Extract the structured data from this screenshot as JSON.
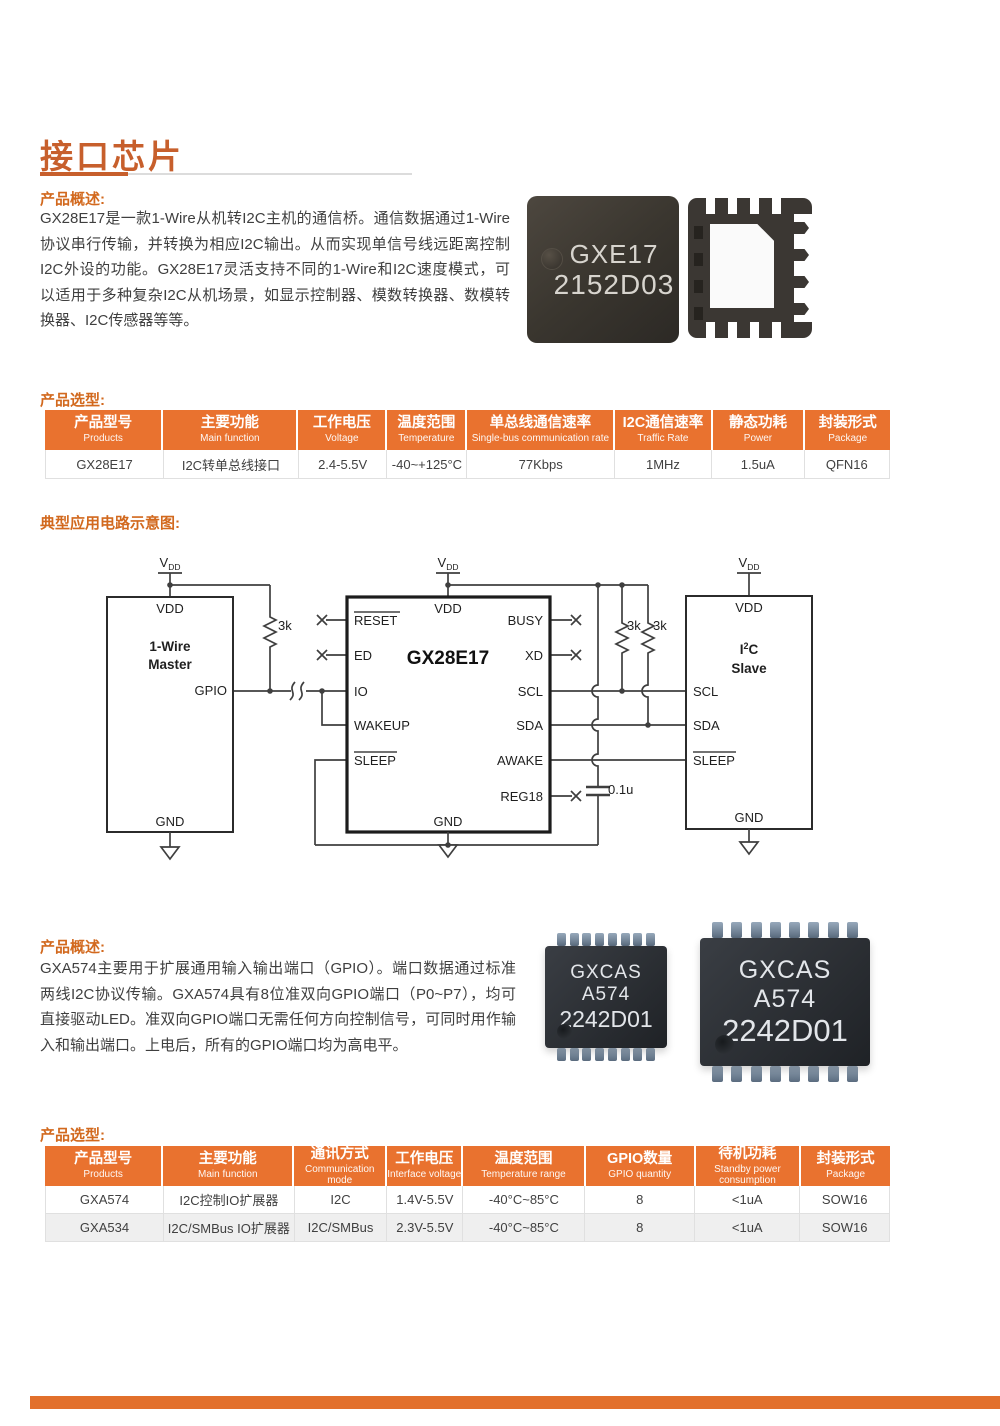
{
  "title": {
    "text": "接口芯片"
  },
  "labels": {
    "overview": "产品概述:",
    "selection": "产品选型:",
    "circuit": "典型应用电路示意图:"
  },
  "overview1": "GX28E17是一款1-Wire从机转I2C主机的通信桥。通信数据通过1-Wire协议串行传输，并转换为相应I2C输出。从而实现单信号线远距离控制I2C外设的功能。GX28E17灵活支持不同的1-Wire和I2C速度模式，可以适用于多种复杂I2C从机场景，如显示控制器、模数转换器、数模转换器、I2C传感器等等。",
  "overview2": "GXA574主要用于扩展通用输入输出端口（GPIO）。端口数据通过标准两线I2C协议传输。GXA574具有8位准双向GPIO端口（P0~P7），均可直接驱动LED。准双向GPIO端口无需任何方向控制信号，可同时用作输入和输出端口。上电后，所有的GPIO端口均为高电平。",
  "chips": {
    "qfn_top": {
      "line1": "GXE17",
      "line2": "2152D03"
    },
    "soic": {
      "line1": "GXCAS",
      "line2": "A574",
      "line3": "2242D01"
    }
  },
  "tables": {
    "t1": {
      "headers": [
        {
          "zh": "产品型号",
          "en": "Products"
        },
        {
          "zh": "主要功能",
          "en": "Main function"
        },
        {
          "zh": "工作电压",
          "en": "Voltage"
        },
        {
          "zh": "温度范围",
          "en": "Temperature"
        },
        {
          "zh": "单总线通信速率",
          "en": "Single-bus communication rate"
        },
        {
          "zh": "I2C通信速率",
          "en": "Traffic Rate"
        },
        {
          "zh": "静态功耗",
          "en": "Power"
        },
        {
          "zh": "封装形式",
          "en": "Package"
        }
      ],
      "rows": [
        [
          "GX28E17",
          "I2C转单总线接口",
          "2.4-5.5V",
          "-40~+125°C",
          "77Kbps",
          "1MHz",
          "1.5uA",
          "QFN16"
        ]
      ]
    },
    "t2": {
      "headers": [
        {
          "zh": "产品型号",
          "en": "Products"
        },
        {
          "zh": "主要功能",
          "en": "Main function"
        },
        {
          "zh": "通讯方式",
          "en": "Communication mode"
        },
        {
          "zh": "工作电压",
          "en": "Interface voltage"
        },
        {
          "zh": "温度范围",
          "en": "Temperature range"
        },
        {
          "zh": "GPIO数量",
          "en": "GPIO quantity"
        },
        {
          "zh": "待机功耗",
          "en": "Standby power consumption"
        },
        {
          "zh": "封装形式",
          "en": "Package"
        }
      ],
      "rows": [
        [
          "GXA574",
          "I2C控制IO扩展器",
          "I2C",
          "1.4V-5.5V",
          "-40°C~85°C",
          "8",
          "<1uA",
          "SOW16"
        ],
        [
          "GXA534",
          "I2C/SMBus IO扩展器",
          "I2C/SMBus",
          "2.3V-5.5V",
          "-40°C~85°C",
          "8",
          "<1uA",
          "SOW16"
        ]
      ]
    }
  },
  "circuit": {
    "vdd_v": "V",
    "vdd_dd": "DD",
    "r": "3k",
    "cap": "0.1u",
    "master": {
      "vdd": "VDD",
      "line1": "1-Wire",
      "line2": "Master",
      "gpio": "GPIO",
      "gnd": "GND"
    },
    "chip": {
      "vdd": "VDD",
      "name": "GX28E17",
      "reset": "RESET",
      "ed": "ED",
      "io": "IO",
      "wakeup": "WAKEUP",
      "sleep": "SLEEP",
      "busy": "BUSY",
      "xd": "XD",
      "scl": "SCL",
      "sda": "SDA",
      "awake": "AWAKE",
      "reg18": "REG18",
      "gnd": "GND"
    },
    "slave": {
      "vdd": "VDD",
      "i2c_i": "I",
      "i2c_sup": "2",
      "i2c_c": "C",
      "name2": "Slave",
      "scl": "SCL",
      "sda": "SDA",
      "sleep": "SLEEP",
      "gnd": "GND"
    }
  },
  "colors": {
    "accent": "#E2702C",
    "title": "#C75F2C",
    "table_header": "#E9722F",
    "row_alt": "#EFEFEF"
  }
}
